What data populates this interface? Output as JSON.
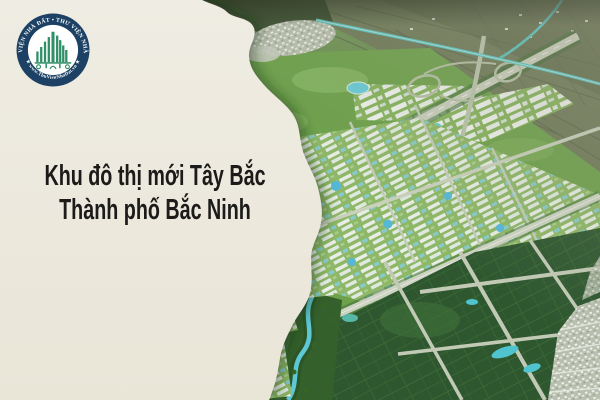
{
  "panel": {
    "title_line1": "Khu đô thị mới Tây Bắc",
    "title_line2": "Thành phố Bắc Ninh"
  },
  "logo": {
    "arc_top": "THƯ VIỆN NHÀ ĐẤT • THƯ VIỆN NHÀ ĐẤT",
    "arc_bottom": "★ www.ThuVienNhaDat.vn ★"
  },
  "colors": {
    "cream": "#ece8dc",
    "title-color": "#1c1b19",
    "logo-ring": "#1c4164",
    "logo-green": "#2f8f66",
    "map-grass": "#6da14b",
    "map-field": "#2e5730",
    "map-road": "#c6cdbb",
    "map-water": "#57c4c0"
  }
}
